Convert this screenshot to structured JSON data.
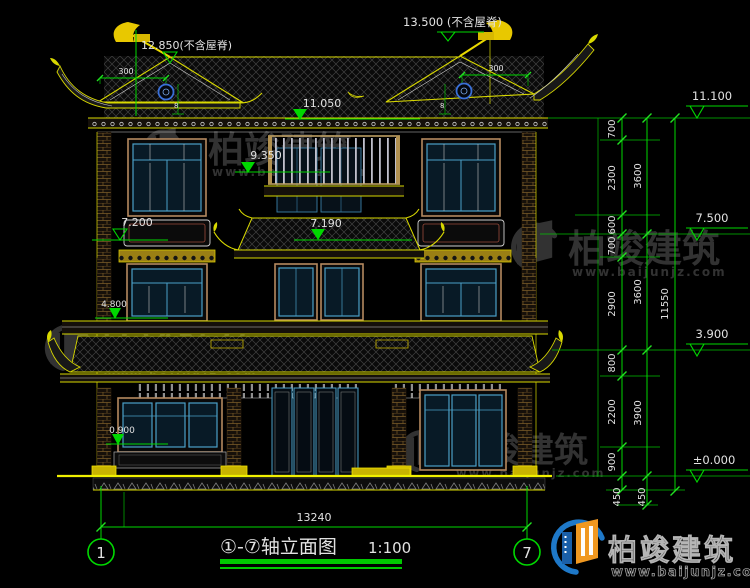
{
  "brand": {
    "name": "柏竣建筑",
    "url": "www.baijunjz.com"
  },
  "title": {
    "text": "①-⑦轴立面图",
    "scale": "1:100"
  },
  "axis": {
    "left": "1",
    "right": "7"
  },
  "dims": {
    "top_ridge_main": "13.500 (不含屋脊)",
    "top_ridge_left": "12.850(不含屋脊)",
    "eave_overhang_left": "300",
    "eave_overhang_right": "300",
    "bottom_width": "13240",
    "right_inner": [
      "700",
      "2300",
      "600",
      "700",
      "2900",
      "800",
      "2200",
      "900"
    ],
    "right_mid": [
      "3600",
      "3600",
      "3900"
    ],
    "right_outer": [
      "11550"
    ],
    "right_below": [
      "450",
      "450"
    ]
  },
  "elevations": {
    "right": [
      "11.100",
      "7.500",
      "3.900",
      "±0.000"
    ],
    "inner": [
      "11.050",
      "9.350",
      "7.200",
      "7.190",
      "4.800",
      "0.900"
    ]
  },
  "callouts": {
    "left": "8",
    "right": "8"
  },
  "colors": {
    "background": "#000000",
    "line_green": "#00d800",
    "line_yellow": "#d8d800",
    "text_white": "#e2e2e2",
    "window_blue": "#4aa0c8",
    "frame_tan": "#b5895f",
    "logo_blue": "#1e78c8",
    "logo_orange": "#f09820"
  }
}
